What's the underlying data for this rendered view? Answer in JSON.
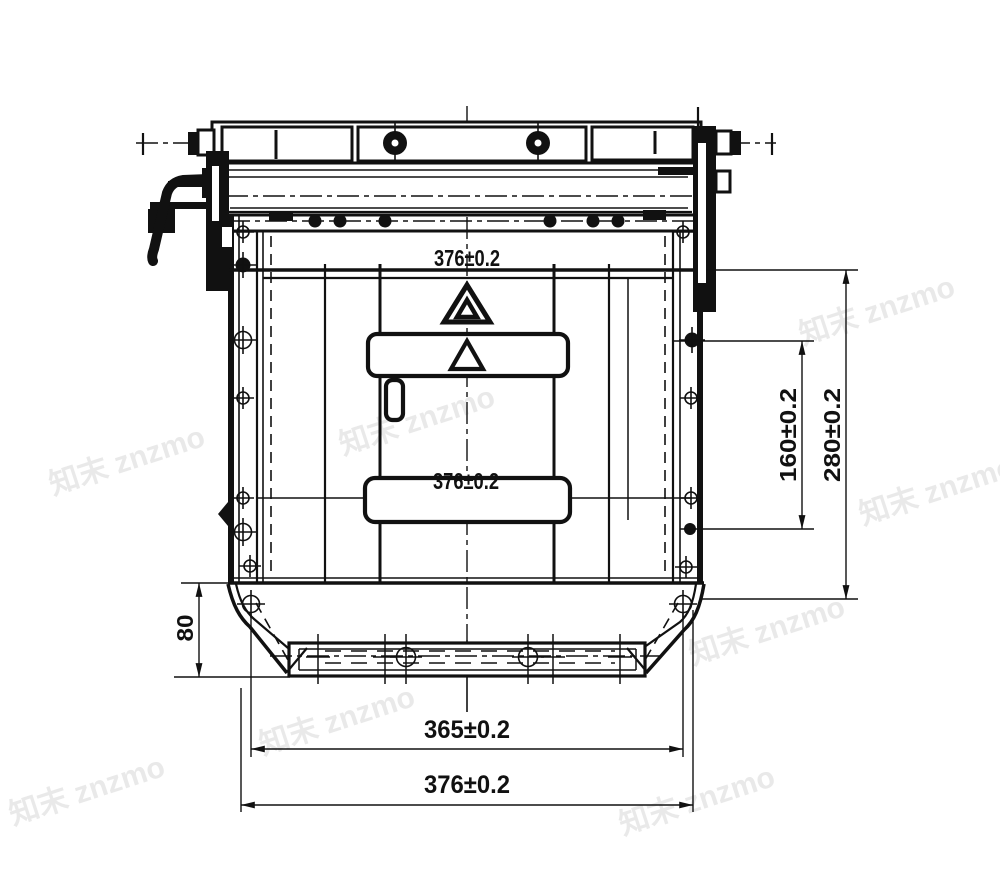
{
  "figure": {
    "type": "engineering-drawing",
    "background_color": "#ffffff",
    "line_color": "#111111",
    "watermark": {
      "text": "知末 znzmo",
      "color": "#e4e4e4"
    },
    "dimensions": {
      "top_width": "376±0.2",
      "panel_width": "376±0.2",
      "bottom_bolt_span": "365±0.2",
      "bottom_overall_width": "376±0.2",
      "side_inner_height": "160±0.2",
      "side_overall_height": "280±0.2",
      "corner_height": "80"
    },
    "symbols": {
      "hazard_triangle": "warning-triangle",
      "fasteners": "bolt-crosshair"
    }
  }
}
